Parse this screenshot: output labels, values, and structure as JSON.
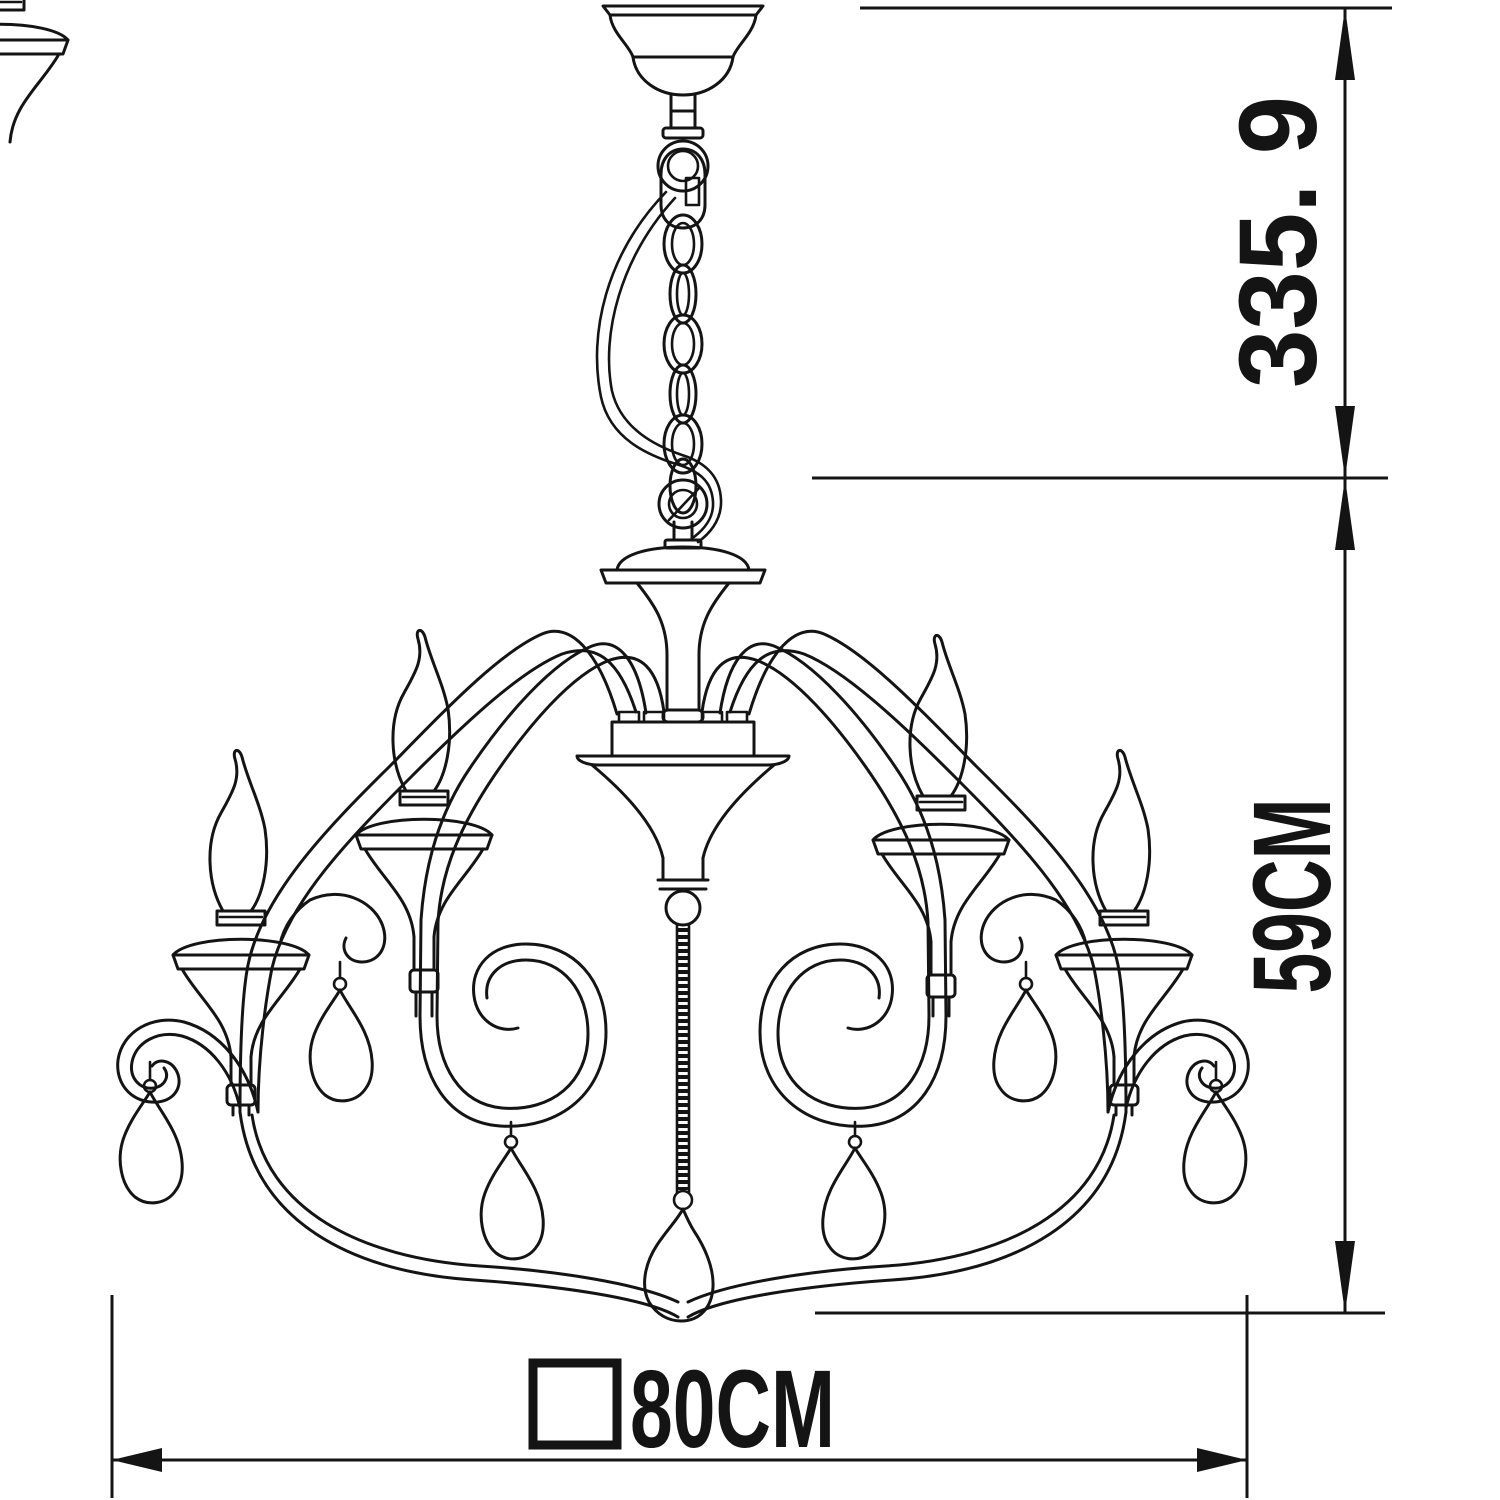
{
  "drawing": {
    "subject": "chandelier line drawing with dimension annotations",
    "line_color": "#141414",
    "background_color": "#ffffff"
  },
  "dimensions": {
    "chain_height_label": "335. 9",
    "body_height_label": "59CM",
    "width_label": "80CM",
    "width_symbol": "square"
  }
}
